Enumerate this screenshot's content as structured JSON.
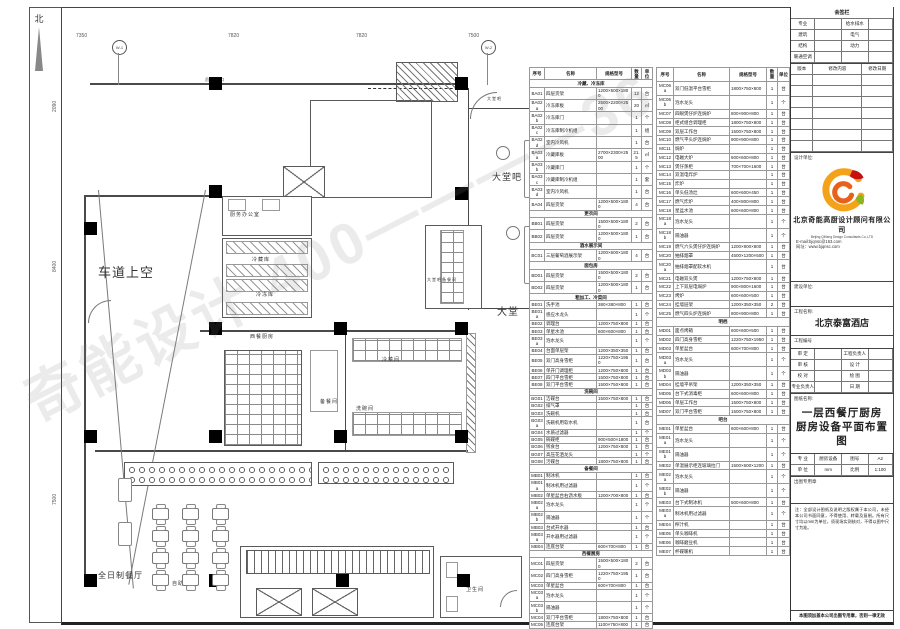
{
  "sheet_title": "一层西餐厅厨房厨房设备平面布置图",
  "watermark": "奇能设计 400————36",
  "plan": {
    "north_label": "北",
    "labels": [
      {
        "t": "车道上空",
        "x": 98,
        "y": 262,
        "s": 13
      },
      {
        "t": "大堂吧",
        "x": 492,
        "y": 170,
        "s": 9
      },
      {
        "t": "大堂吧",
        "x": 487,
        "y": 96,
        "s": 4
      },
      {
        "t": "大堂",
        "x": 497,
        "y": 303,
        "s": 10
      },
      {
        "t": "全日制餐厅",
        "x": 98,
        "y": 570,
        "s": 8
      },
      {
        "t": "自助餐台",
        "x": 172,
        "y": 580,
        "s": 5
      },
      {
        "t": "冷藏库",
        "x": 252,
        "y": 256,
        "s": 5
      },
      {
        "t": "冷冻库",
        "x": 256,
        "y": 291,
        "s": 5
      },
      {
        "t": "厨务办公室",
        "x": 230,
        "y": 211,
        "s": 5
      },
      {
        "t": "西餐厨房",
        "x": 250,
        "y": 333,
        "s": 5
      },
      {
        "t": "冷菜间",
        "x": 382,
        "y": 356,
        "s": 5
      },
      {
        "t": "备餐间",
        "x": 320,
        "y": 398,
        "s": 5
      },
      {
        "t": "洗碗间",
        "x": 356,
        "y": 405,
        "s": 5
      },
      {
        "t": "大堂吧备餐间",
        "x": 427,
        "y": 277,
        "s": 4
      },
      {
        "t": "卫生间",
        "x": 466,
        "y": 586,
        "s": 5
      },
      {
        "t": "员工入口",
        "x": 205,
        "y": 77,
        "s": 4
      }
    ],
    "top_dims": [
      {
        "t": "7350",
        "x": 76
      },
      {
        "t": "7820",
        "x": 228
      },
      {
        "t": "7820",
        "x": 356
      },
      {
        "t": "7500",
        "x": 468
      }
    ],
    "left_dims": [
      {
        "t": "2090",
        "y": 112
      },
      {
        "t": "8400",
        "y": 272
      },
      {
        "t": "7500",
        "y": 505
      }
    ],
    "bubbles": [
      {
        "t": "W-1",
        "x": 112
      },
      {
        "t": "W-2",
        "x": 481
      }
    ],
    "columns": [
      [
        84,
        222
      ],
      [
        84,
        430
      ],
      [
        84,
        574
      ],
      [
        209,
        77
      ],
      [
        209,
        185
      ],
      [
        209,
        322
      ],
      [
        209,
        430
      ],
      [
        209,
        574
      ],
      [
        334,
        322
      ],
      [
        334,
        430
      ],
      [
        336,
        574
      ],
      [
        455,
        77
      ],
      [
        455,
        187
      ],
      [
        455,
        322
      ],
      [
        455,
        430
      ],
      [
        457,
        574
      ]
    ]
  },
  "tables": {
    "headers": [
      "序号",
      "名称",
      "规格型号",
      "数量",
      "单位"
    ],
    "left": [
      {
        "section": "冷藏、冷冻库"
      },
      [
        "BA01",
        "四层货架",
        "1200×500×1800",
        "12",
        "台"
      ],
      [
        "BA02a",
        "冷冻库板",
        "2500×2200×2500",
        "20",
        "㎡"
      ],
      [
        "BA02b",
        "冷冻库门",
        "",
        "1",
        "个"
      ],
      [
        "BA02c",
        "冷冻库制冷机组",
        "",
        "1",
        "组"
      ],
      [
        "BA02d",
        "室内冷风机",
        "",
        "1",
        "台"
      ],
      [
        "BA03a",
        "冷藏库板",
        "2700×2300×2500",
        "21.5",
        "㎡"
      ],
      [
        "BA03b",
        "冷藏库门",
        "",
        "1",
        "个"
      ],
      [
        "BA03c",
        "冷藏库制冷机组",
        "",
        "1",
        "套"
      ],
      [
        "BA03d",
        "室内冷风机",
        "",
        "1",
        "台"
      ],
      [
        "BA04",
        "四层货架",
        "1200×500×1800",
        "4",
        "台"
      ],
      {
        "section": "更衣间"
      },
      [
        "BB01",
        "四层货架",
        "1500×500×1800",
        "2",
        "台"
      ],
      [
        "BB02",
        "四层货架",
        "1200×500×1800",
        "1",
        "台"
      ],
      {
        "section": "酒水展示间"
      },
      [
        "BC01",
        "三层葡萄酒展示架",
        "1200×600×1800",
        "4",
        "台"
      ],
      {
        "section": "面包房"
      },
      [
        "BD01",
        "四层货架",
        "1500×500×1800",
        "2",
        "台"
      ],
      [
        "BD02",
        "四层货架",
        "1200×500×1800",
        "1",
        "台"
      ],
      {
        "section": "粗加工、冷菜间"
      },
      [
        "BE01",
        "洗手池",
        "380×380×800",
        "1",
        "台"
      ],
      [
        "BE01a",
        "感应水龙头",
        "",
        "1",
        "个"
      ],
      [
        "BE02",
        "调理台",
        "1200×750×800",
        "1",
        "台"
      ],
      [
        "BE03",
        "单星水池",
        "600×600×800",
        "1",
        "台"
      ],
      [
        "BE03a",
        "泡水龙头",
        "",
        "1",
        "个"
      ],
      [
        "BE04",
        "台面单层架",
        "1200×350×350",
        "1",
        "台"
      ],
      [
        "BE05",
        "双门高身雪柜",
        "1220×750×1950",
        "1",
        "台"
      ],
      [
        "BE06",
        "单开门调理柜",
        "1200×750×800",
        "1",
        "台"
      ],
      [
        "BE07",
        "四门平台雪柜",
        "1500×750×800",
        "1",
        "台"
      ],
      [
        "BE08",
        "双门平台雪柜",
        "1500×750×800",
        "1",
        "台"
      ],
      {
        "section": "洗碗间"
      },
      [
        "BG01",
        "洁碟台",
        "1500×750×800",
        "1",
        "台"
      ],
      [
        "BG02",
        "排气罩",
        "",
        "1",
        "台"
      ],
      [
        "BG03",
        "洗碗机",
        "",
        "1",
        "台"
      ],
      [
        "BG03a",
        "洗碗机用软水机",
        "",
        "1",
        "台"
      ],
      [
        "BG04",
        "水质过滤器",
        "",
        "1",
        "个"
      ],
      [
        "BG05",
        "碗碟柜",
        "900×500×1800",
        "1",
        "台"
      ],
      [
        "BG06",
        "残食台",
        "1200×750×800",
        "1",
        "台"
      ],
      [
        "BG07",
        "高压花洒龙头",
        "",
        "1",
        "个"
      ],
      [
        "BG08",
        "污碟台",
        "1800×750×800",
        "1",
        "台"
      ],
      {
        "section": "备餐间"
      },
      [
        "MB01",
        "制冰机",
        "",
        "1",
        "台"
      ],
      [
        "MB01a",
        "制冰机用过滤器",
        "",
        "1",
        "个"
      ],
      [
        "MB02",
        "单星盆台右沥水板",
        "1200×700×800",
        "1",
        "台"
      ],
      [
        "MB02a",
        "泡水龙头",
        "",
        "1",
        "个"
      ],
      [
        "MB02b",
        "隔油器",
        "",
        "1",
        "个"
      ],
      [
        "MB03",
        "台式开水器",
        "",
        "1",
        "台"
      ],
      [
        "MB03a",
        "开水器用过滤器",
        "",
        "1",
        "个"
      ],
      [
        "MB04",
        "连底台架",
        "600×700×800",
        "1",
        "台"
      ],
      {
        "section": "西餐厨房"
      },
      [
        "MC01",
        "四层货架",
        "1500×500×1800",
        "2",
        "台"
      ],
      [
        "MC02",
        "四门高身雪柜",
        "1220×750×1950",
        "1",
        "台"
      ],
      [
        "MC03",
        "单星盆台",
        "600×700×800",
        "1",
        "台"
      ],
      [
        "MC03a",
        "泡水龙头",
        "",
        "1",
        "个"
      ],
      [
        "MC03b",
        "隔油器",
        "",
        "1",
        "个"
      ],
      [
        "MC04",
        "双门平台雪柜",
        "1800×750×800",
        "1",
        "台"
      ],
      [
        "MC05",
        "连底台架",
        "1100×750×800",
        "1",
        "台"
      ]
    ],
    "right": [
      [
        "MC06a",
        "双门低温平台雪柜",
        "1800×750×800",
        "1",
        "台"
      ],
      [
        "MC06b",
        "泡水龙头",
        "",
        "1",
        "个"
      ],
      [
        "MC07",
        "四眼煲仔炉连焗炉",
        "800×900×800",
        "1",
        "台"
      ],
      [
        "MC08",
        "柜式组合调理柜",
        "1800×750×800",
        "1",
        "台"
      ],
      [
        "MC09",
        "双层工作台",
        "1500×750×800",
        "1",
        "台"
      ],
      [
        "MC10",
        "燃气平头炉连焗炉",
        "900×900×800",
        "1",
        "台"
      ],
      [
        "MC11",
        "焗炉",
        "",
        "1",
        "台"
      ],
      [
        "MC12",
        "电磁大炉",
        "600×600×800",
        "1",
        "台"
      ],
      [
        "MC13",
        "煲仔蒸柜",
        "700×700×1600",
        "1",
        "台"
      ],
      [
        "MC14",
        "双温电炸炉",
        "",
        "1",
        "台"
      ],
      [
        "MC15",
        "炸炉",
        "",
        "1",
        "台"
      ],
      [
        "MC16",
        "单头低汤灶",
        "600×600×450",
        "1",
        "台"
      ],
      [
        "MC17",
        "燃气炸炉",
        "400×800×800",
        "1",
        "台"
      ],
      [
        "MC18",
        "星盆水池",
        "600×600×800",
        "1",
        "台"
      ],
      [
        "MC18a",
        "泡水龙头",
        "",
        "1",
        "个"
      ],
      [
        "MC18b",
        "隔油器",
        "",
        "1",
        "个"
      ],
      [
        "MC19",
        "燃气六头煲仔炉连焗炉",
        "1200×900×800",
        "1",
        "台"
      ],
      [
        "MC20",
        "抽排烟罩",
        "4500×1200×500",
        "1",
        "台"
      ],
      [
        "MC20a",
        "抽排烟罩配软水机",
        "",
        "1",
        "台"
      ],
      [
        "MC21",
        "电磁双头煲",
        "1200×750×800",
        "1",
        "台"
      ],
      [
        "MC22",
        "上下双层电焗炉",
        "900×800×1600",
        "1",
        "台"
      ],
      [
        "MC23",
        "烤炉",
        "600×600×500",
        "1",
        "台"
      ],
      [
        "MC24",
        "挂墙层架",
        "1200×350×350",
        "2",
        "台"
      ],
      [
        "MC25",
        "燃气四头炉连焗炉",
        "800×900×800",
        "1",
        "台"
      ],
      {
        "section": "明档"
      },
      [
        "MD01",
        "面点烤箱",
        "600×600×500",
        "1",
        "台"
      ],
      [
        "MD02",
        "四门高身雪柜",
        "1220×750×1950",
        "1",
        "台"
      ],
      [
        "MD03",
        "单星盆台",
        "600×700×800",
        "1",
        "台"
      ],
      [
        "MD03a",
        "泡水龙头",
        "",
        "1",
        "个"
      ],
      [
        "MD03b",
        "隔油器",
        "",
        "1",
        "个"
      ],
      [
        "MD04",
        "挂墙平吊架",
        "1200×350×350",
        "1",
        "台"
      ],
      [
        "MD05",
        "台下式消毒柜",
        "600×600×800",
        "1",
        "台"
      ],
      [
        "MD06",
        "单层工作台",
        "1500×750×800",
        "1",
        "台"
      ],
      [
        "MD07",
        "双门平台雪柜",
        "1500×750×800",
        "1",
        "台"
      ],
      {
        "section": "吧台"
      },
      [
        "ME01",
        "单星盆台",
        "600×600×800",
        "1",
        "台"
      ],
      [
        "ME01a",
        "泡水龙头",
        "",
        "1",
        "个"
      ],
      [
        "ME01b",
        "隔油器",
        "",
        "1",
        "个"
      ],
      [
        "ME02",
        "单温展示柜连玻璃拉门",
        "1500×600×1200",
        "1",
        "台"
      ],
      [
        "ME02a",
        "泡水龙头",
        "",
        "1",
        "个"
      ],
      [
        "ME02b",
        "隔油器",
        "",
        "1",
        "个"
      ],
      [
        "ME03",
        "台下式制冰机",
        "500×600×800",
        "1",
        "台"
      ],
      [
        "ME03a",
        "制冰机用过滤器",
        "",
        "1",
        "个"
      ],
      [
        "ME04",
        "榨汁机",
        "",
        "1",
        "台"
      ],
      [
        "ME05",
        "单头咖啡机",
        "",
        "1",
        "台"
      ],
      [
        "ME06",
        "咖啡磨豆机",
        "",
        "1",
        "台"
      ],
      [
        "ME07",
        "杯碟暖机",
        "",
        "1",
        "台"
      ]
    ]
  },
  "title_block": {
    "signoff": {
      "title": "会签栏",
      "rows": [
        [
          "专业",
          "",
          "给水排水",
          ""
        ],
        [
          "建筑",
          "",
          "电气",
          ""
        ],
        [
          "结构",
          "",
          "动力",
          ""
        ],
        [
          "暖通空调",
          "",
          "",
          ""
        ]
      ]
    },
    "revisions": {
      "headers": [
        "版本",
        "修改内容",
        "修改日期"
      ],
      "empty_rows": 7
    },
    "design_unit_label": "设计单位:",
    "company": {
      "name_cn": "北京奇能高厨设计顾问有限公司",
      "name_en": "Beijing QiNeng Design Consultants Co.,LTD",
      "email": "E-mail:bjqnsc@163.com",
      "web": "网址：www.bjqnsc.com"
    },
    "client_label": "建设单位:",
    "project_label": "工程名称:",
    "project_name": "北京泰富酒店",
    "project_no_label": "工程编号",
    "sign_grid": [
      [
        "审 定",
        "",
        "工程负责人",
        ""
      ],
      [
        "审 核",
        "",
        "设 计",
        ""
      ],
      [
        "校 对",
        "",
        "绘 图",
        ""
      ],
      [
        "专业负责人",
        "",
        "日 期",
        ""
      ]
    ],
    "drawing_label": "图纸名称:",
    "drawing_title_line1": "一层西餐厅厨房",
    "drawing_title_line2": "厨房设备平面布置图",
    "spec_grid": [
      [
        "专 业",
        "厨房设备",
        "图号",
        "A2"
      ],
      [
        "单 位",
        "mm",
        "比例",
        "1:100"
      ]
    ],
    "stamp_label": "出图专用章",
    "notes": "注：全部设计图纸及说明之版权属于本公司，未经本公司书面同意，不得使用、转载及复制。所有尺寸均以mm为单位，须现场实测核对，不得以图中尺寸为准。",
    "declaration": "本图须加盖本公司出图专用章，否则一律无效"
  }
}
